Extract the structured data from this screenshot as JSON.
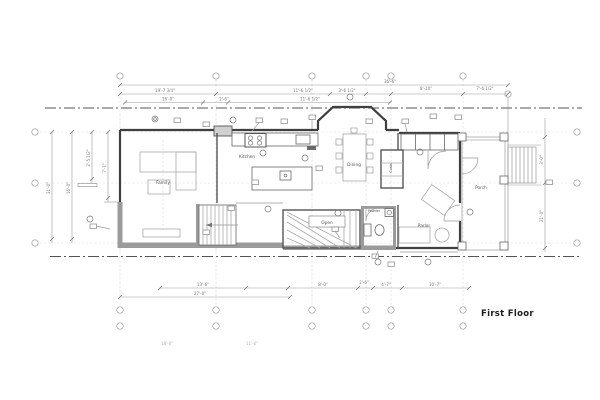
{
  "title": {
    "label": "First Floor"
  },
  "rooms": {
    "family": "Family",
    "kitchen": "Kitchen",
    "dining": "Dining",
    "coats": "Coats",
    "parlor": "Parlor",
    "porch": "Porch",
    "open": "Open",
    "powder": "Powder"
  },
  "dimensions": {
    "t1": "36'-6\"",
    "t2a": "19'-7 3/4\"",
    "t2b": "11'-6 1/2\"",
    "t2c": "3'-6 1/2\"",
    "t2d": "8'-10\"",
    "t2e": "7'-6 1/2\"",
    "t3a": "16'-0\"",
    "t3b": "2'-6\"",
    "t3c": "11'-6 1/2\"",
    "ba": "13'-6\"",
    "bb": "8'-0\"",
    "bc": "2'-6\"",
    "bd": "4'-7\"",
    "be": "10'-7\"",
    "bf": "27'-0\"",
    "bg": "18'-0\"",
    "bh": "11'-6\"",
    "la": "2'-5 1/2\"",
    "lb": "7'-1\"",
    "lc": "16'-0\"",
    "ld": "31'-0\"",
    "ra": "21'-0\"",
    "rb": "3'-0\""
  },
  "colors": {
    "background": "#ffffff",
    "wall": "#3f3f3f",
    "poche": "#9b9b9b",
    "dimension_line": "#9a9a9a",
    "grid_line": "#555555",
    "label_text": "#555555",
    "title_text": "#1b1b1b"
  }
}
